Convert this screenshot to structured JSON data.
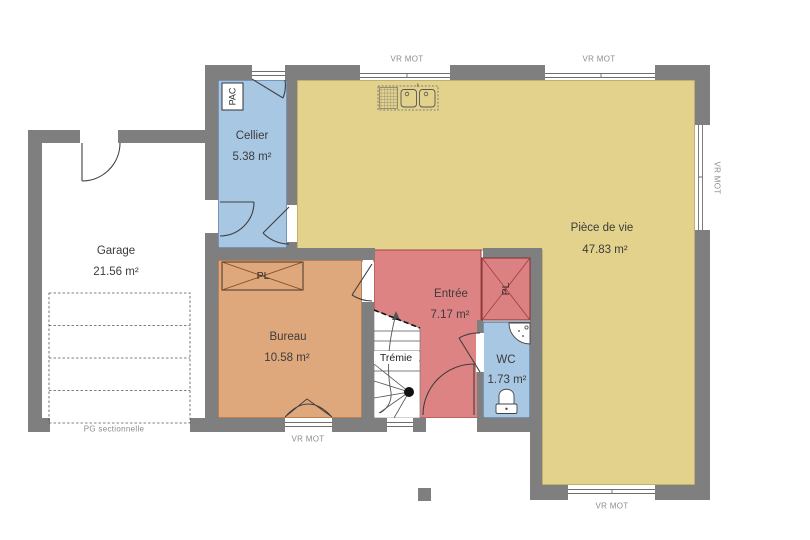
{
  "rooms": {
    "garage": {
      "name": "Garage",
      "area": "21.56 m²"
    },
    "cellier": {
      "name": "Cellier",
      "area": "5.38 m²"
    },
    "piece_de_vie": {
      "name": "Pièce de vie",
      "area": "47.83 m²"
    },
    "bureau": {
      "name": "Bureau",
      "area": "10.58 m²"
    },
    "entree": {
      "name": "Entrée",
      "area": "7.17 m²"
    },
    "wc": {
      "name": "WC",
      "area": "1.73 m²"
    },
    "tremie": {
      "name": "Trémie"
    }
  },
  "fixtures": {
    "heat_pump_label": "PAC",
    "closet_bureau_label": "PL",
    "closet_entree_label": "PL",
    "garage_door_label": "PG sectionnelle"
  },
  "window_labels": {
    "roller_shutter_motor": "VR MOT"
  },
  "colors": {
    "wall": "#7f7f7f",
    "blue_room_fill": "#a8c7e3",
    "living_room_fill": "#e3d28c",
    "office_fill": "#dfa77c",
    "entry_fill": "#de8383"
  }
}
